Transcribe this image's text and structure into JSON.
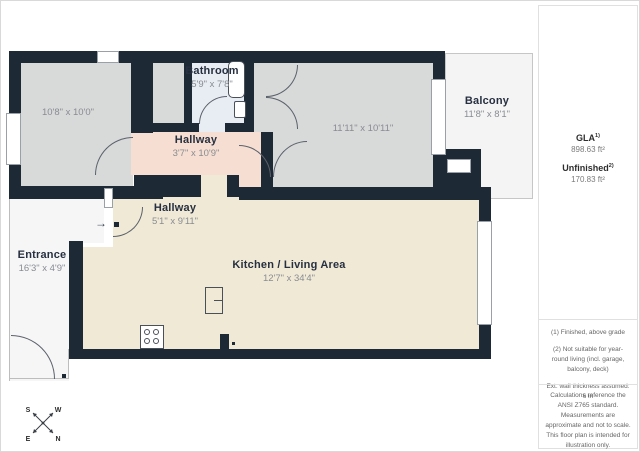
{
  "rooms": {
    "bedroom": {
      "dims": "10'8\" x 10'0\""
    },
    "bathroom": {
      "name": "Bathroom",
      "dims": "5'9\" x 7'8\""
    },
    "bedroom2": {
      "dims": "11'11\" x 10'11\""
    },
    "balcony": {
      "name": "Balcony",
      "dims": "11'8\" x 8'1\""
    },
    "hallway_upper": {
      "name": "Hallway",
      "dims": "3'7\" x 10'9\""
    },
    "hallway_lower": {
      "name": "Hallway",
      "dims": "5'1\" x 9'11\""
    },
    "entrance": {
      "name": "Entrance",
      "dims": "16'3\" x 4'9\""
    },
    "kitchen": {
      "name": "Kitchen / Living Area",
      "dims": "12'7\" x 34'4\""
    }
  },
  "sidebar": {
    "gla_label": "GLA",
    "gla_sup": "1)",
    "gla_value": "898.63 ft²",
    "unfinished_label": "Unfinished",
    "unfinished_sup": "2)",
    "unfinished_value": "170.83 ft²",
    "footnotes": [
      "(1) Finished, above grade",
      "(2) Not suitable for year-round living (incl. garage, balcony, deck)",
      "Ext. wall thickness assumed: 6 in",
      "Calculations reference the ANSI Z765 standard. Measurements are approximate and not to scale. This floor plan is intended for illustration only."
    ],
    "logo_text": "GIRAFFE",
    "logo_sup": "360"
  },
  "compass": {
    "n": "N",
    "s": "S",
    "e": "E",
    "w": "W"
  },
  "icons": {
    "entry_arrow": "→"
  },
  "colors": {
    "wall": "#1e2936",
    "room_gray": "#d8d9d9",
    "bathroom_blue": "#e8ecf3",
    "hallway_peach": "#f6dfd2",
    "kitchen_cream": "#f0e9d6"
  }
}
